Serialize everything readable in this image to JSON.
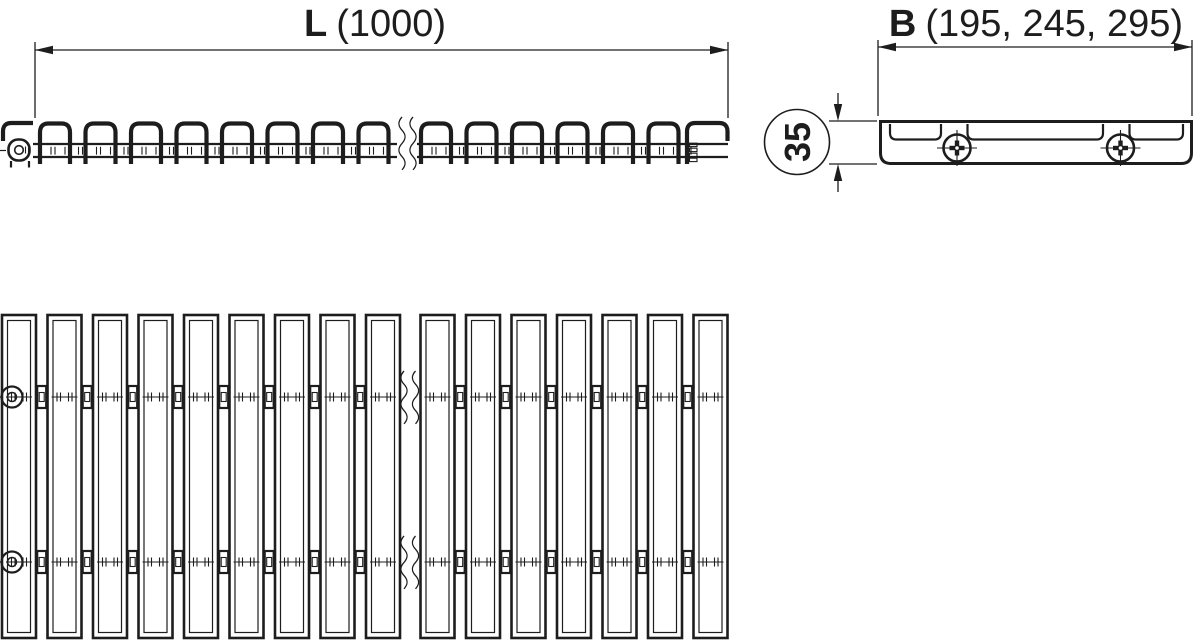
{
  "labels": {
    "length": {
      "symbol": "L",
      "values": "(1000)"
    },
    "width": {
      "symbol": "B",
      "values": "(195, 245, 295)"
    },
    "height": "35"
  },
  "colors": {
    "ink": "#1d1d1d",
    "background": "#ffffff"
  }
}
